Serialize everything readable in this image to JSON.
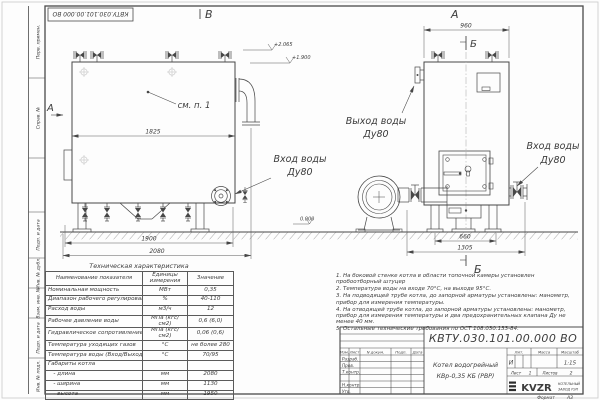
{
  "frame": {
    "doc_number_stamp": "КВТУ.030.101.00.000 ВО",
    "side_labels": [
      "Перв. примен.",
      "Справ. №",
      "Подп. и дата",
      "Инв. № дубл.",
      "Взам. инв. №",
      "Подп. и дата",
      "Инв. № подл."
    ]
  },
  "views": {
    "view_b": "В",
    "view_a_top": "А",
    "view_a_side": "А",
    "section_b_top": "Б",
    "section_b_bottom": "Б",
    "see_note": "см. п. 1",
    "dim_1825": "1825",
    "dim_1900": "1900",
    "dim_2080": "2080",
    "dim_960": "960",
    "dim_660": "660",
    "dim_1305": "1305",
    "elev_top": "+2.065",
    "elev_mid": "+1.900",
    "elev_zero": "0.000",
    "inlet_side_1": "Вход воды",
    "inlet_side_2": "Ду80",
    "outlet_1": "Выход воды",
    "outlet_2": "Ду80",
    "inlet_front_1": "Вход воды",
    "inlet_front_2": "Ду80"
  },
  "spec_table": {
    "title": "Техническая характеристика",
    "headers": [
      "Наименование показателя",
      "Единицы измерения",
      "Значение"
    ],
    "rows": [
      {
        "name": "Номинальная мощность",
        "unit": "МВт",
        "value": "0,35"
      },
      {
        "name": "Диапазон рабочего регулирования",
        "unit": "%",
        "value": "40-110"
      },
      {
        "name": "Расход воды",
        "unit": "м3/ч",
        "value": "12"
      },
      {
        "name": "Рабочее давление воды",
        "unit": "МПа (кгс/см2)",
        "value": "0,6 (6,0)"
      },
      {
        "name": "Гидравлическое сопротивление котла",
        "unit": "МПа (кгс/см2)",
        "value": "0,06 (0,6)"
      },
      {
        "name": "Температура уходящих газов",
        "unit": "°С",
        "value": "не более 280"
      },
      {
        "name": "Температура воды (Вход/Выход)",
        "unit": "°С",
        "value": "70/95"
      },
      {
        "name": "Габариты котла",
        "unit": "",
        "value": ""
      },
      {
        "name": "   - длина",
        "unit": "мм",
        "value": "2080"
      },
      {
        "name": "   - ширина",
        "unit": "мм",
        "value": "1130"
      },
      {
        "name": "   - высота",
        "unit": "мм",
        "value": "1950"
      }
    ]
  },
  "notes": {
    "items": [
      "1. На боковой стенке котла в области топочной камеры установлен пробоотборный штуцер",
      "2. Температура воды на входе 70°С, на выходе 95°С.",
      "3. На подводящей трубе котла, до запорной арматуры установлены: манометр, прибор для измерения температуры.",
      "4. На отводящей трубе котла, до запорной арматуры установлены: манометр, прибор для измерения температуры и два предохранительных клапана Ду не менее 40 мм.",
      "5. Остальные технические требования по ОСТ 108.030.133-84."
    ]
  },
  "title_block": {
    "doc_number": "КВТУ.030.101.00.000  ВО",
    "product_line1": "Котел водогрейный",
    "product_line2": "КВр-0,35 КБ (РВР)",
    "col_headers": [
      "Изм.",
      "Лист",
      "N докум.",
      "Подп.",
      "Дата"
    ],
    "row_labels": [
      "Разраб.",
      "Пров.",
      "Т.контр.",
      "Н.контр.",
      "Утв."
    ],
    "lit_header": "Лит.",
    "mass_header": "Масса",
    "scale_header": "Масштаб",
    "lit_value": "И",
    "scale_value": "1:15",
    "sheet_label": "Лист",
    "sheet_num": "1",
    "sheets_label": "Листов",
    "sheets_num": "2",
    "logo_text": "KVZR",
    "logo_sub1": "КОТЕЛЬНЫЙ",
    "logo_sub2": "ЗАВОД РЭП",
    "format_label": "Формат",
    "format_value": "А3"
  }
}
